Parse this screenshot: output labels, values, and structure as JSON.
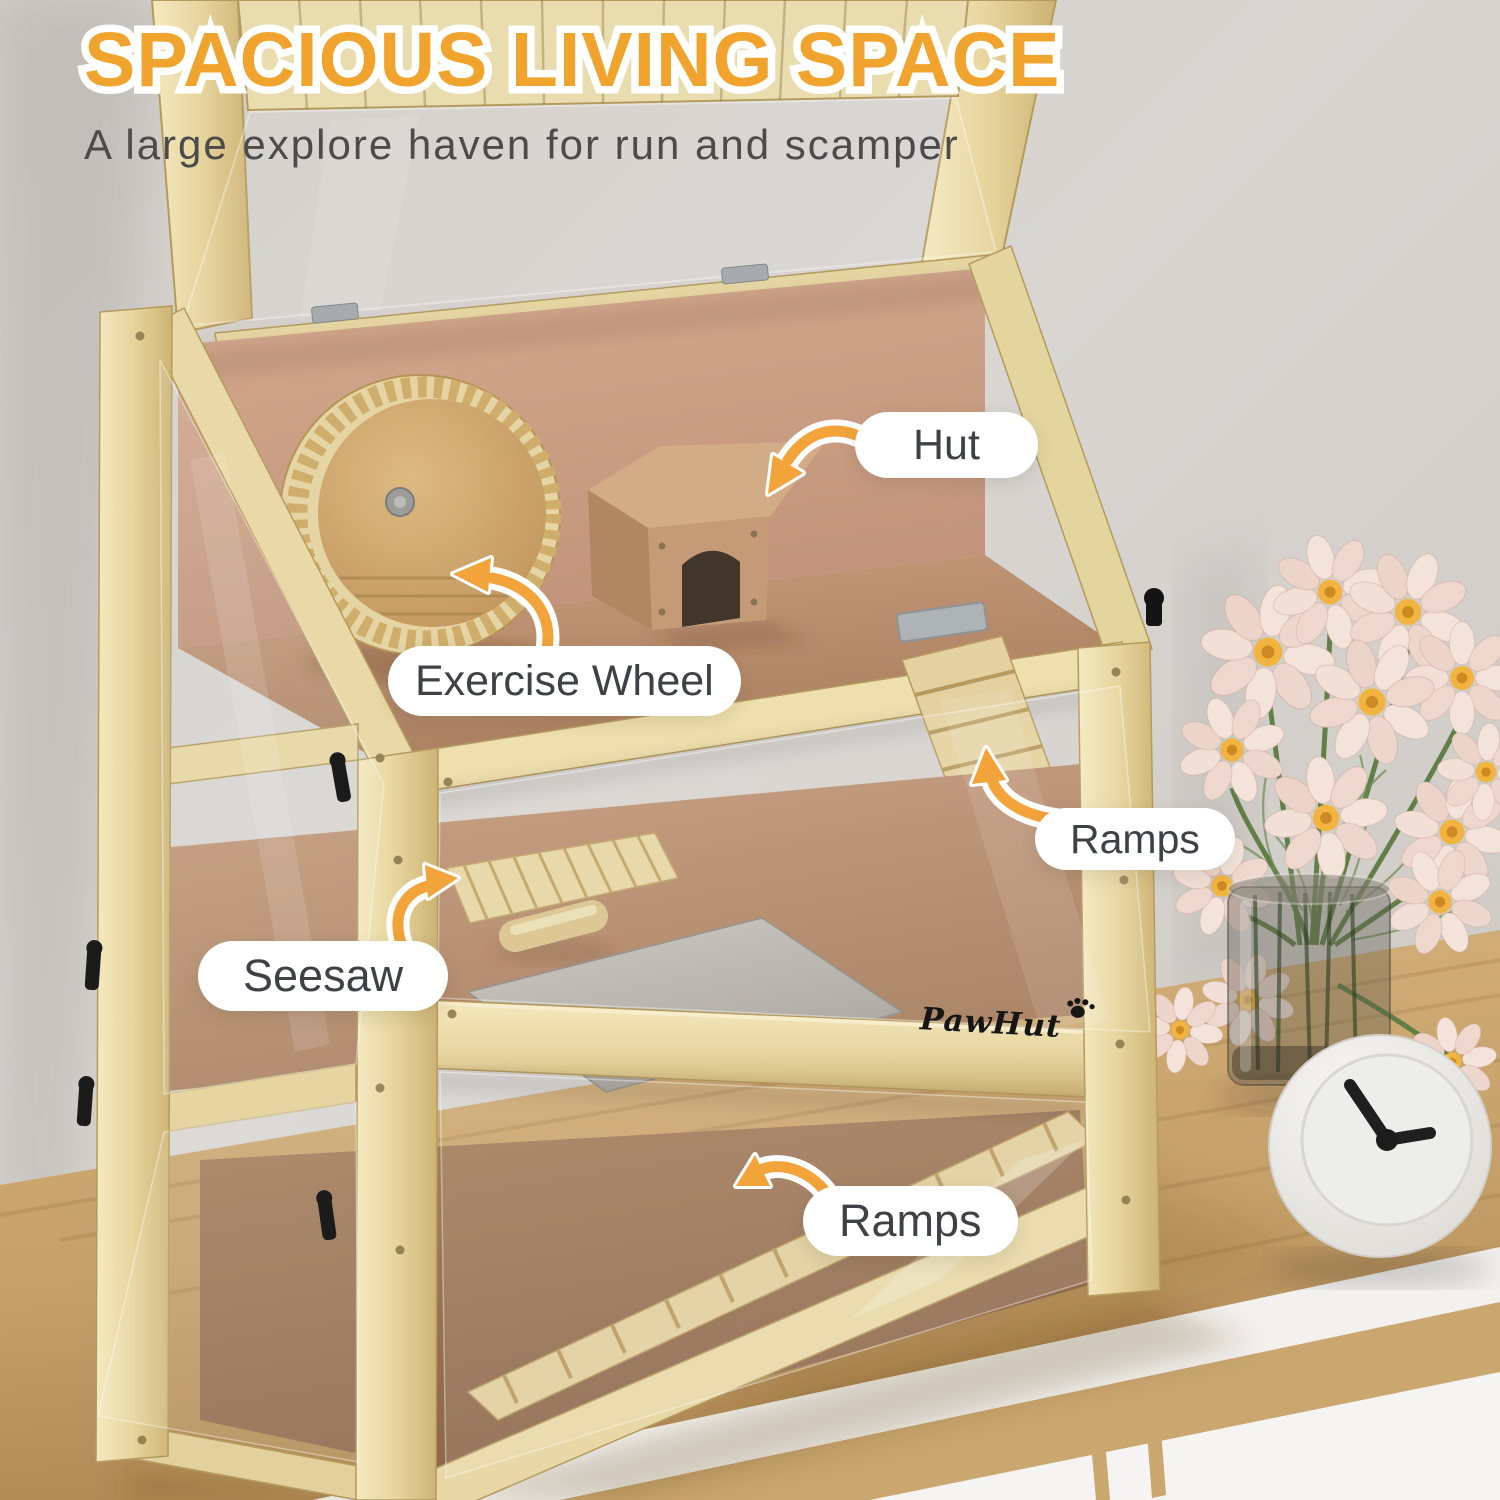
{
  "header": {
    "title": "SPACIOUS LIVING SPACE",
    "subtitle": "A large explore haven for run and scamper"
  },
  "brand": {
    "name": "PawHut"
  },
  "callouts": [
    {
      "id": "hut",
      "label": "Hut"
    },
    {
      "id": "exercise-wheel",
      "label": "Exercise Wheel"
    },
    {
      "id": "ramps-upper",
      "label": "Ramps"
    },
    {
      "id": "seesaw",
      "label": "Seesaw"
    },
    {
      "id": "ramps-lower",
      "label": "Ramps"
    }
  ],
  "palette": {
    "accent_orange": "#F2A33A",
    "title_color": "#F1A42D",
    "subtitle_color": "#4B4B4B",
    "label_text_color": "#3E4247",
    "label_bg": "#FFFFFF",
    "wood_light": "#EDE0AF",
    "fleece_tan": "#C0946F",
    "wall_gray": "#D5D2CE"
  }
}
